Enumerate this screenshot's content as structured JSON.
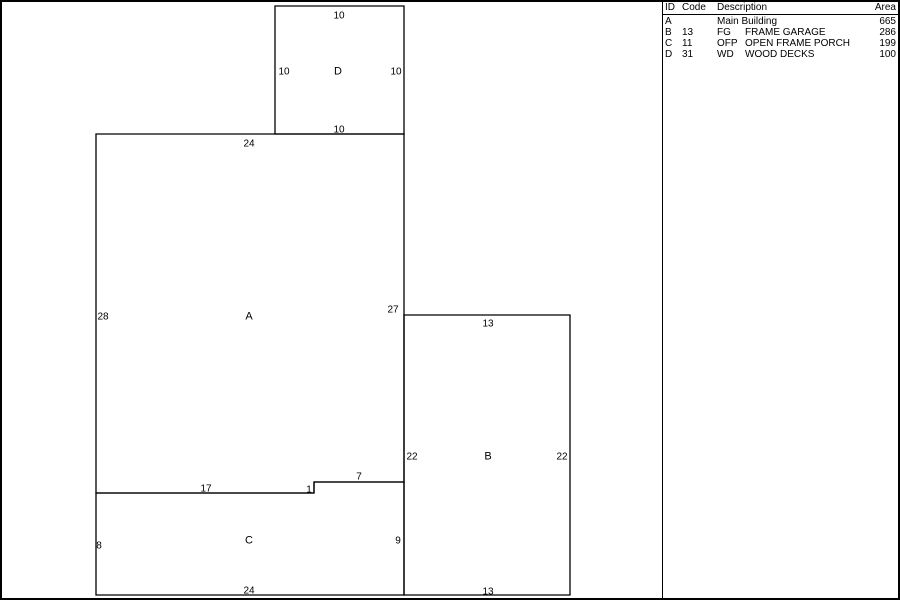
{
  "sketch": {
    "line_color": "#000000",
    "background_color": "#ffffff",
    "areas": [
      {
        "id": "A",
        "points": [
          [
            94,
            132
          ],
          [
            402,
            132
          ],
          [
            402,
            480
          ],
          [
            312,
            480
          ],
          [
            312,
            491
          ],
          [
            94,
            491
          ]
        ]
      },
      {
        "id": "B",
        "points": [
          [
            402,
            313
          ],
          [
            568,
            313
          ],
          [
            568,
            593
          ],
          [
            402,
            593
          ]
        ]
      },
      {
        "id": "C",
        "points": [
          [
            94,
            491
          ],
          [
            312,
            491
          ],
          [
            312,
            480
          ],
          [
            402,
            480
          ],
          [
            402,
            593
          ],
          [
            94,
            593
          ]
        ]
      },
      {
        "id": "D",
        "points": [
          [
            273,
            4
          ],
          [
            402,
            4
          ],
          [
            402,
            132
          ],
          [
            273,
            132
          ]
        ]
      }
    ],
    "labels": [
      {
        "text": "10",
        "x": 337,
        "y": 13,
        "kind": "dim"
      },
      {
        "text": "10",
        "x": 282,
        "y": 69,
        "kind": "dim"
      },
      {
        "text": "D",
        "x": 336,
        "y": 69,
        "kind": "area"
      },
      {
        "text": "10",
        "x": 394,
        "y": 69,
        "kind": "dim"
      },
      {
        "text": "10",
        "x": 337,
        "y": 127,
        "kind": "dim"
      },
      {
        "text": "24",
        "x": 247,
        "y": 141,
        "kind": "dim"
      },
      {
        "text": "28",
        "x": 101,
        "y": 314,
        "kind": "dim"
      },
      {
        "text": "A",
        "x": 247,
        "y": 314,
        "kind": "area"
      },
      {
        "text": "27",
        "x": 391,
        "y": 307,
        "kind": "dim"
      },
      {
        "text": "13",
        "x": 486,
        "y": 321,
        "kind": "dim"
      },
      {
        "text": "22",
        "x": 410,
        "y": 454,
        "kind": "dim"
      },
      {
        "text": "B",
        "x": 486,
        "y": 454,
        "kind": "area"
      },
      {
        "text": "22",
        "x": 560,
        "y": 454,
        "kind": "dim"
      },
      {
        "text": "7",
        "x": 357,
        "y": 474,
        "kind": "dim"
      },
      {
        "text": "17",
        "x": 204,
        "y": 486,
        "kind": "dim"
      },
      {
        "text": "1",
        "x": 307,
        "y": 487,
        "kind": "dim"
      },
      {
        "text": "8",
        "x": 97,
        "y": 543,
        "kind": "dim"
      },
      {
        "text": "C",
        "x": 247,
        "y": 538,
        "kind": "area"
      },
      {
        "text": "9",
        "x": 396,
        "y": 538,
        "kind": "dim"
      },
      {
        "text": "24",
        "x": 247,
        "y": 588,
        "kind": "dim"
      },
      {
        "text": "13",
        "x": 486,
        "y": 589,
        "kind": "dim"
      }
    ]
  },
  "legend": {
    "headers": {
      "id": "ID",
      "code": "Code",
      "description": "Description",
      "area": "Area"
    },
    "rows": [
      {
        "id": "A",
        "code": "",
        "abbrev": "",
        "name": "Main Building",
        "area": "665"
      },
      {
        "id": "B",
        "code": "13",
        "abbrev": "FG",
        "name": "FRAME GARAGE",
        "area": "286"
      },
      {
        "id": "C",
        "code": "11",
        "abbrev": "OFP",
        "name": "OPEN FRAME PORCH",
        "area": "199"
      },
      {
        "id": "D",
        "code": "31",
        "abbrev": "WD",
        "name": "WOOD DECKS",
        "area": "100"
      }
    ]
  }
}
